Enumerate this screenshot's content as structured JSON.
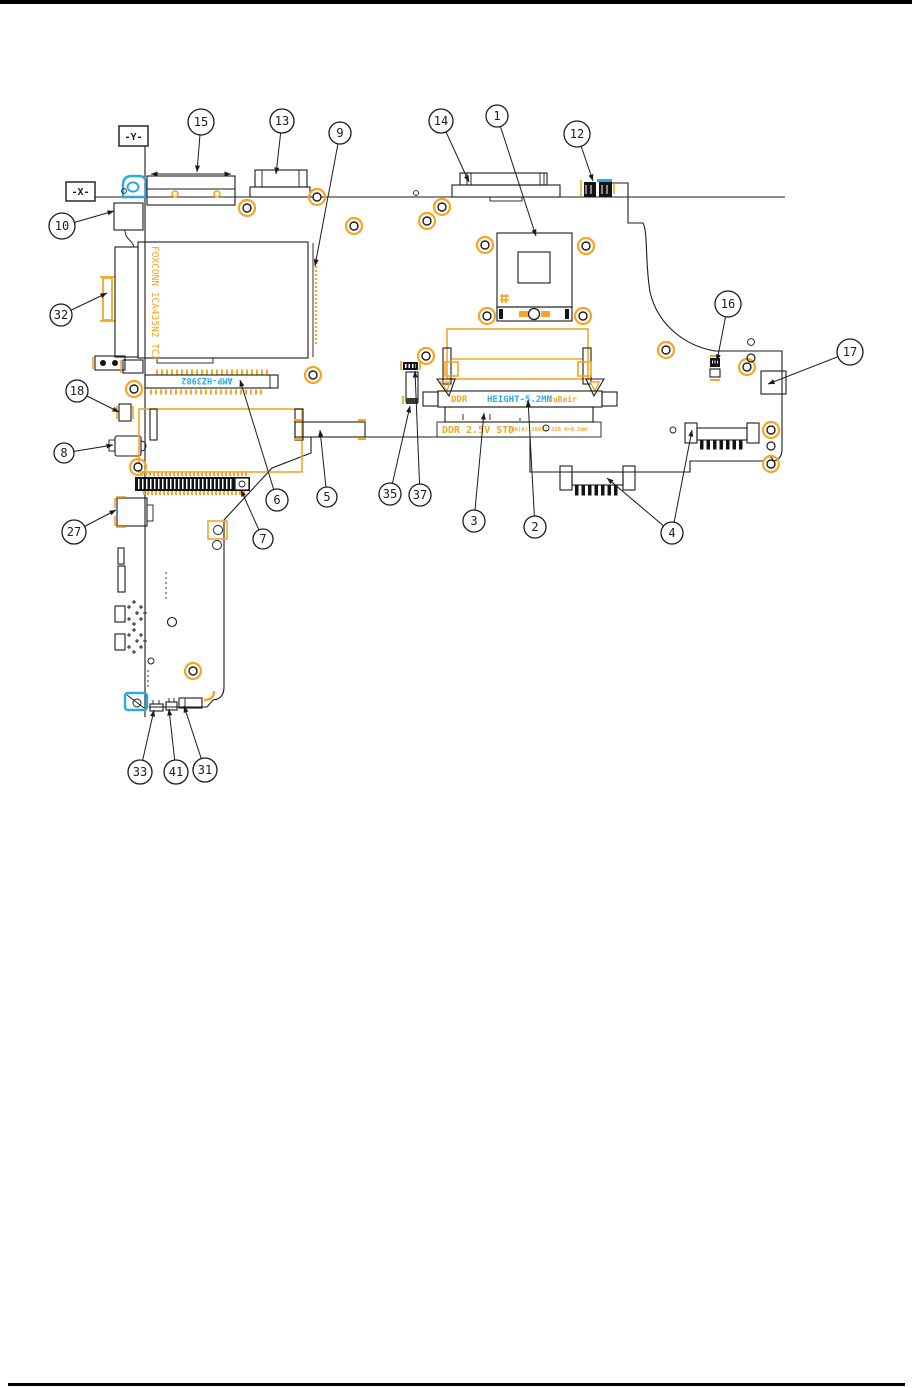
{
  "page": {
    "background": "#ffffff",
    "top_bar_color": "#000000",
    "bottom_rule_color": "#000000"
  },
  "colors": {
    "line": "#1b1b1b",
    "highlight_orange": "#F5A623",
    "highlight_cyan": "#29ABE2",
    "component_black": "#141414"
  },
  "axis": {
    "y_label": "-Y-",
    "x_label": "-X-"
  },
  "texts": {
    "heatsink_marking": "FOXCONN 1CA435N2 TC2",
    "docking_connector_marking": "AMP-HZ3982",
    "ddr_label": "DDR",
    "ddr_height": "HEIGHT-5.2MM",
    "ddr_right_marking": "zuBair",
    "ddr_spec": "DDR 2.5V STD",
    "ddr_spec_small": "200(A) 200S1 220 H=0.5mm"
  },
  "callouts": [
    {
      "n": "1",
      "x": 497,
      "y": 116,
      "r": 11,
      "t": [
        [
          536,
          236
        ]
      ]
    },
    {
      "n": "12",
      "x": 577,
      "y": 134,
      "r": 13,
      "t": [
        [
          593,
          181
        ]
      ]
    },
    {
      "n": "14",
      "x": 441,
      "y": 121,
      "r": 12,
      "t": [
        [
          469,
          182
        ]
      ]
    },
    {
      "n": "13",
      "x": 282,
      "y": 121,
      "r": 12,
      "t": [
        [
          276,
          174
        ]
      ]
    },
    {
      "n": "15",
      "x": 201,
      "y": 122,
      "r": 13,
      "t": [
        [
          197,
          172
        ]
      ]
    },
    {
      "n": "9",
      "x": 340,
      "y": 133,
      "r": 11,
      "t": [
        [
          315,
          266
        ]
      ]
    },
    {
      "n": "10",
      "x": 62,
      "y": 226,
      "r": 13,
      "t": [
        [
          114,
          211
        ]
      ]
    },
    {
      "n": "32",
      "x": 61,
      "y": 315,
      "r": 11,
      "t": [
        [
          107,
          293
        ]
      ]
    },
    {
      "n": "16",
      "x": 728,
      "y": 304,
      "r": 13,
      "t": [
        [
          717,
          361
        ]
      ]
    },
    {
      "n": "17",
      "x": 850,
      "y": 352,
      "r": 13,
      "t": [
        [
          768,
          384
        ]
      ]
    },
    {
      "n": "18",
      "x": 77,
      "y": 391,
      "r": 11,
      "t": [
        [
          119,
          412
        ]
      ]
    },
    {
      "n": "8",
      "x": 64,
      "y": 453,
      "r": 10,
      "t": [
        [
          113,
          445
        ]
      ]
    },
    {
      "n": "27",
      "x": 74,
      "y": 532,
      "r": 12,
      "t": [
        [
          116,
          510
        ]
      ]
    },
    {
      "n": "6",
      "x": 277,
      "y": 500,
      "r": 11,
      "t": [
        [
          240,
          380
        ]
      ]
    },
    {
      "n": "7",
      "x": 263,
      "y": 539,
      "r": 10,
      "t": [
        [
          241,
          490
        ]
      ]
    },
    {
      "n": "5",
      "x": 327,
      "y": 497,
      "r": 10,
      "t": [
        [
          320,
          430
        ]
      ]
    },
    {
      "n": "35",
      "x": 390,
      "y": 494,
      "r": 11,
      "t": [
        [
          410,
          406
        ]
      ]
    },
    {
      "n": "37",
      "x": 420,
      "y": 495,
      "r": 11,
      "t": [
        [
          415,
          371
        ]
      ]
    },
    {
      "n": "3",
      "x": 474,
      "y": 521,
      "r": 11,
      "t": [
        [
          484,
          413
        ]
      ]
    },
    {
      "n": "2",
      "x": 535,
      "y": 527,
      "r": 11,
      "t": [
        [
          528,
          400
        ]
      ]
    },
    {
      "n": "4",
      "x": 672,
      "y": 533,
      "r": 11,
      "t": [
        [
          607,
          478
        ],
        [
          692,
          430
        ]
      ]
    },
    {
      "n": "33",
      "x": 140,
      "y": 772,
      "r": 12,
      "t": [
        [
          154,
          710
        ]
      ]
    },
    {
      "n": "41",
      "x": 176,
      "y": 772,
      "r": 12,
      "t": [
        [
          169,
          709
        ]
      ]
    },
    {
      "n": "31",
      "x": 205,
      "y": 770,
      "r": 12,
      "t": [
        [
          184,
          706
        ]
      ]
    }
  ]
}
